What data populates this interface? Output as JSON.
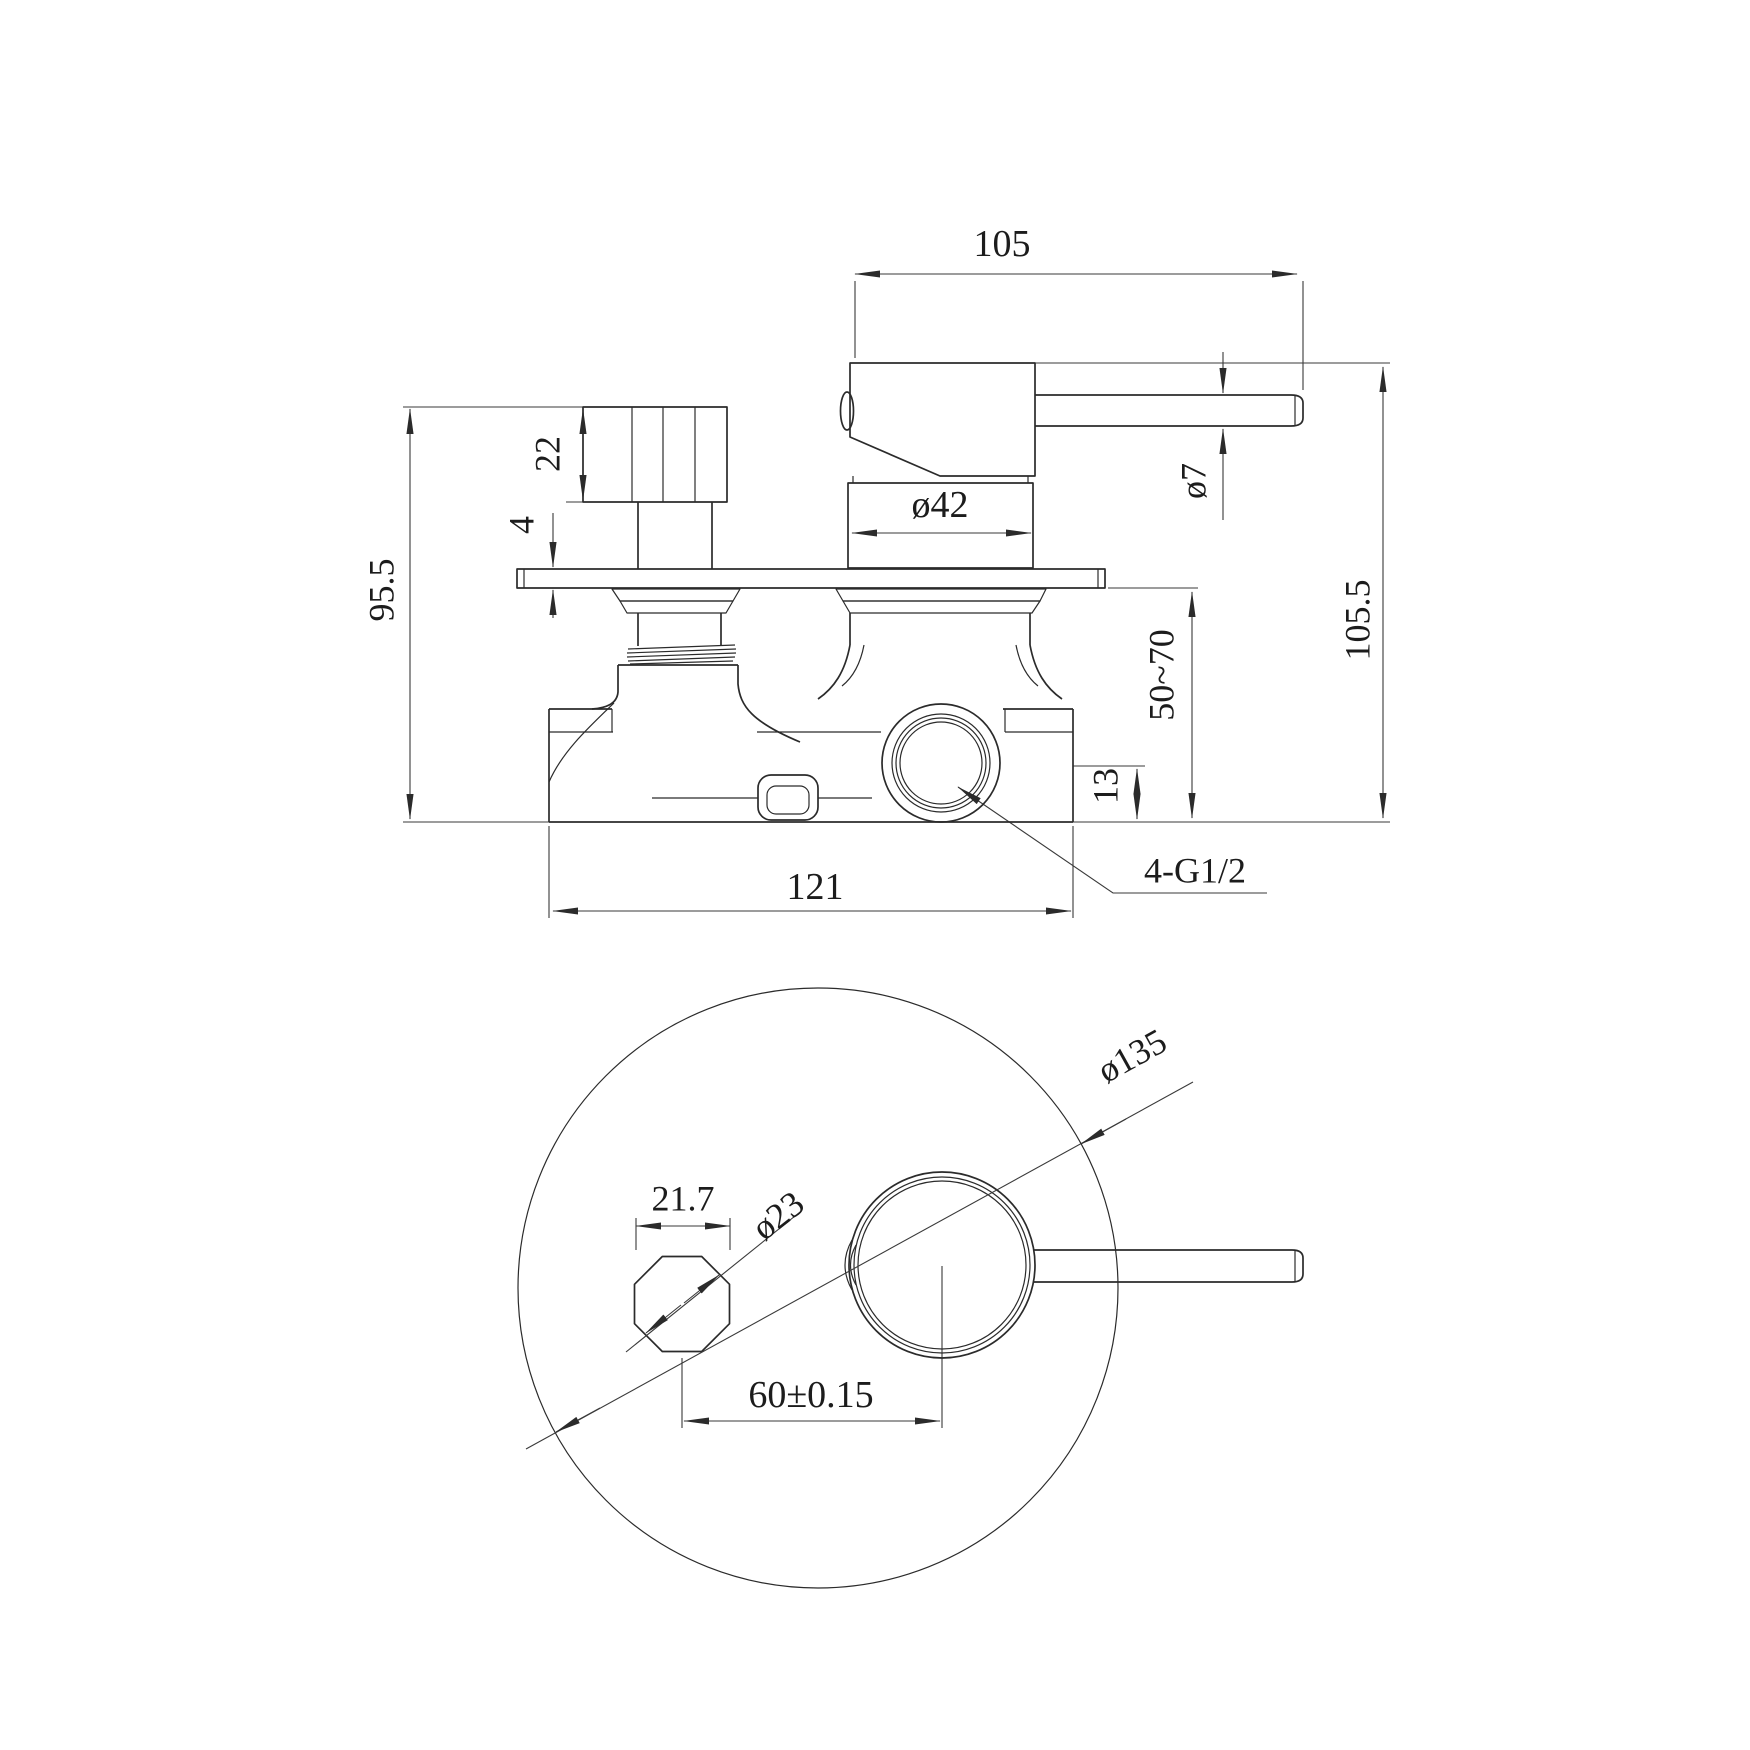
{
  "drawing": {
    "side_view": {
      "dim_handle_length": "105",
      "dim_knob_height": "22",
      "dim_plate_thickness": "4",
      "dim_body_height": "95.5",
      "dim_cartridge_diameter": "ø42",
      "dim_lever_diameter": "ø7",
      "dim_overall_height": "105.5",
      "dim_wall_depth_range": "50~70",
      "dim_port_height": "13",
      "dim_body_width": "121",
      "thread_spec": "4-G1/2"
    },
    "bottom_view": {
      "dim_plate_diameter": "ø135",
      "dim_spindle_flats": "21.7",
      "dim_spindle_diameter": "ø23",
      "dim_center_distance": "60±0.15"
    }
  }
}
